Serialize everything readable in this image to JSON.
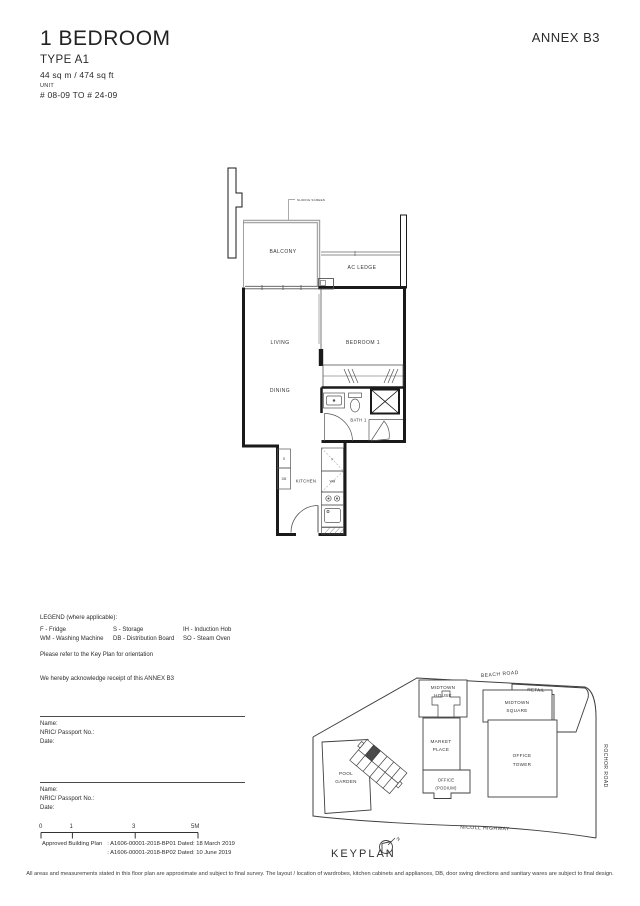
{
  "header": {
    "title": "1 BEDROOM",
    "type": "TYPE A1",
    "area": "44 sq m / 474 sq ft",
    "unit_label": "UNIT",
    "unit_range": "# 08-09 TO # 24-09",
    "annex": "ANNEX B3"
  },
  "floorplan": {
    "annotation_sliding_screen": "SLIDING SCREEN",
    "rooms": {
      "balcony": "BALCONY",
      "ac_ledge": "AC LEDGE",
      "living": "LIVING",
      "bedroom": "BEDROOM 1",
      "dining": "DINING",
      "bath": "BATH 1",
      "kitchen": "KITCHEN"
    },
    "fixtures": {
      "storage": "S",
      "db": "DB",
      "fridge": "F",
      "wm": "WM"
    }
  },
  "legend": {
    "title": "LEGEND (where applicable):",
    "items": [
      "F - Fridge",
      "S - Storage",
      "IH - Induction Hob",
      "WM - Washing Machine",
      "DB - Distribution Board",
      "SO - Steam Oven"
    ]
  },
  "notes": {
    "keyplan_note": "Please refer to the Key Plan for orientation",
    "acknowledgement": "We hereby acknowledge receipt of this ANNEX B3"
  },
  "signature": {
    "name_label": "Name:",
    "nric_label": "NRIC/ Passport No.:",
    "date_label": "Date:"
  },
  "scale_bar": {
    "ticks": [
      "0",
      "1",
      "3",
      "5M"
    ]
  },
  "approval": {
    "label": "Approved Building Plan",
    "lines": [
      ": A1606-00001-2018-BP01  Dated: 18 March 2019",
      ": A1606-00001-2018-BP02  Dated: 10 June 2019"
    ]
  },
  "keyplan": {
    "label": "KEYPLAN",
    "north": "N",
    "roads": {
      "beach": "BEACH ROAD",
      "nicoll": "NICOLL HIGHWAY",
      "rochor": "ROCHOR ROAD"
    },
    "buildings": {
      "midtown_house": [
        "MIDTOWN",
        "HOUSE"
      ],
      "retail": [
        "RETAIL"
      ],
      "midtown_square": [
        "MIDTOWN",
        "SQUARE"
      ],
      "market_place": [
        "MARKET",
        "PLACE"
      ],
      "office_tower": [
        "OFFICE",
        "TOWER"
      ],
      "office_podium": [
        "OFFICE",
        "(PODIUM)"
      ],
      "pool_garden": [
        "POOL",
        "GARDEN"
      ]
    }
  },
  "footer": {
    "disclaimer": "All areas and measurements stated in this floor plan are approximate and subject to final survey. The layout / location of wardrobes, kitchen cabinets and appliances, DB, door swing directions and sanitary wares are subject to final design."
  },
  "colors": {
    "ink": "#2b2b2b",
    "wall": "#1a1a1a",
    "screen_gray": "#9c9c9c",
    "highlight_unit": "#4a4a4a"
  }
}
